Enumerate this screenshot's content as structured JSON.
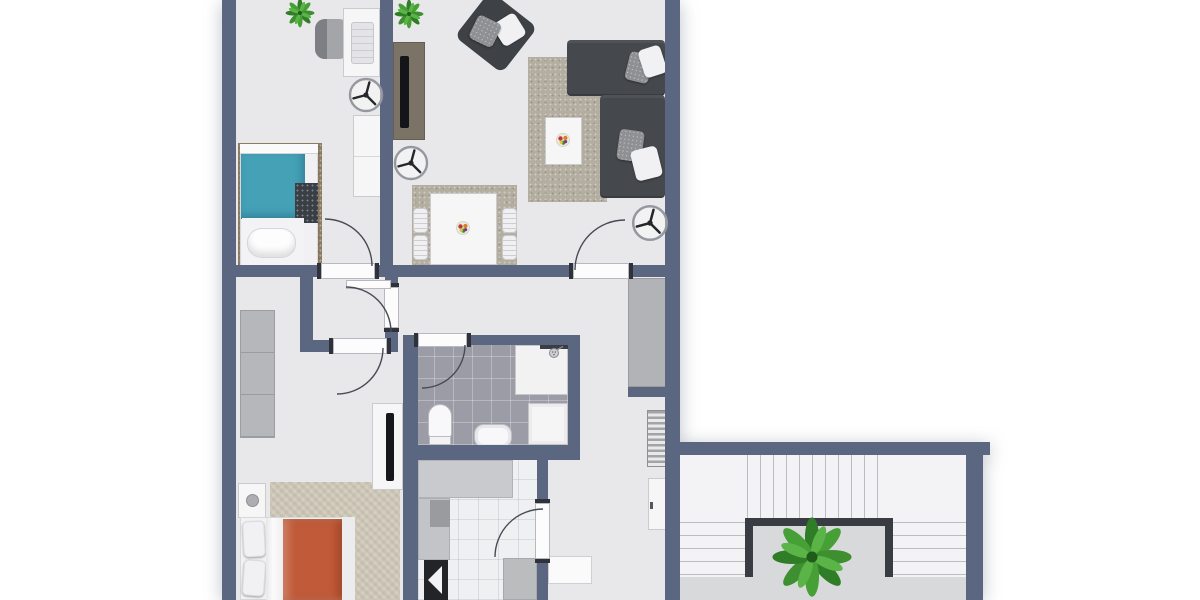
{
  "scene": {
    "type": "2d-floor-plan",
    "description": "Top-down rendered apartment floor plan, cropped at the top and bottom edges",
    "background": "#ffffff"
  },
  "palette": {
    "wall": "#5b6680",
    "floor": "#e8e8ea",
    "bathroom_tile": "#9b9ca6",
    "kitchen_tile": "#eef0f1",
    "stair_floor": "#dcdddf",
    "stair_tread": "#f3f3f5",
    "railing": "#393c42",
    "rug_beige": "#b4aea1",
    "rug_brown": "#8c7c63",
    "rug_cream": "#cfc8b8",
    "bed_teal": "#44a1b6",
    "bed_orange": "#c05a38",
    "sofa_gray": "#45484d",
    "console_taupe": "#7b7366",
    "closet_gray": "#b2b3b6",
    "plant_green": "#3e8f2f"
  },
  "rooms": [
    {
      "name": "bedroom-top-left",
      "furniture": [
        "single bed with teal duvet and dark folded blanket",
        "brown rug",
        "desk with laptop",
        "office chair",
        "white wardrobe",
        "ceiling fan",
        "potted plant",
        "door to vestibule"
      ]
    },
    {
      "name": "living-dining-room",
      "furniture": [
        "dark corner sofa with pillows",
        "dark accent armchair",
        "beige area rug",
        "coffee table with flowers",
        "TV sideboard",
        "dining table with flowers and four slatted chairs on gray rug",
        "two ceiling fans",
        "potted plant",
        "door to hallway"
      ]
    },
    {
      "name": "vestibule",
      "furniture": [
        "door to bedroom-top-left",
        "door to hallway",
        "door to bedroom-bottom-left"
      ]
    },
    {
      "name": "hallway",
      "furniture": [
        "built-in gray closet",
        "radiator",
        "small white cabinet",
        "floor threshold"
      ]
    },
    {
      "name": "bathroom",
      "furniture": [
        "shower with glass strip and shower head",
        "toilet",
        "washbasin",
        "washing machine"
      ]
    },
    {
      "name": "kitchen",
      "furniture": [
        "counter along top wall",
        "left counter with cooktop square",
        "dark appliance with white wedge",
        "lower-right counter block"
      ]
    },
    {
      "name": "bedroom-bottom-left",
      "furniture": [
        "double bed with orange duvet and two white pillows",
        "nightstand with round lamp",
        "tall gray wardrobe",
        "wall TV panel",
        "cream herringbone rug"
      ]
    },
    {
      "name": "stairwell",
      "furniture": [
        "U-shaped staircase with two side flights and top flight",
        "dark U-shaped railing",
        "central potted plant"
      ]
    }
  ],
  "doors": [
    {
      "from": "vestibule",
      "to": "bedroom-top-left",
      "swing": "into bedroom"
    },
    {
      "from": "vestibule",
      "to": "hallway",
      "swing": "into vestibule"
    },
    {
      "from": "vestibule",
      "to": "bedroom-bottom-left",
      "swing": "into bedroom"
    },
    {
      "from": "hallway",
      "to": "living-dining-room",
      "swing": "into living room"
    },
    {
      "from": "hallway",
      "to": "bathroom",
      "swing": "into bathroom"
    },
    {
      "from": "hallway",
      "to": "kitchen",
      "swing": "into kitchen"
    }
  ]
}
